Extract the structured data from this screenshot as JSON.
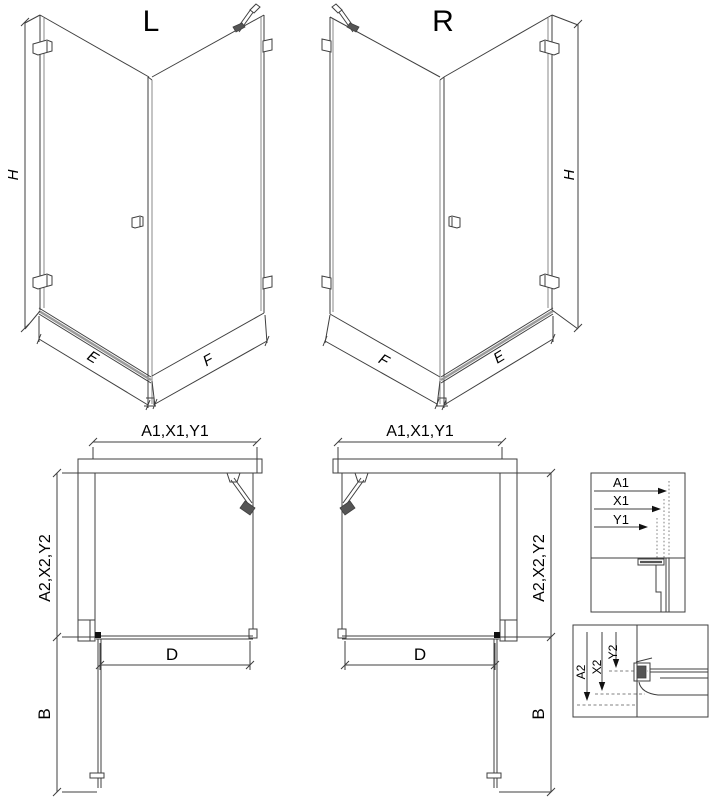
{
  "drawing": {
    "iso_left": {
      "variant": "L",
      "dim_height": "H",
      "dim_door": "E",
      "dim_side": "F"
    },
    "iso_right": {
      "variant": "R",
      "dim_height": "H",
      "dim_door": "E",
      "dim_side": "F"
    },
    "plan_left": {
      "dim_top": "A1,X1,Y1",
      "dim_side": "A2,X2,Y2",
      "dim_opening": "D",
      "dim_door": "B"
    },
    "plan_right": {
      "dim_top": "A1,X1,Y1",
      "dim_side": "A2,X2,Y2",
      "dim_opening": "D",
      "dim_door": "B"
    },
    "detail_top": {
      "dim_a1": "A1",
      "dim_x1": "X1",
      "dim_y1": "Y1"
    },
    "detail_bottom": {
      "dim_a2": "A2",
      "dim_x2": "X2",
      "dim_y2": "Y2"
    },
    "colors": {
      "line": "#3f3f3f",
      "text": "#000000",
      "background": "#ffffff",
      "hatch": "#666666",
      "fitting_dark": "#555555"
    }
  }
}
